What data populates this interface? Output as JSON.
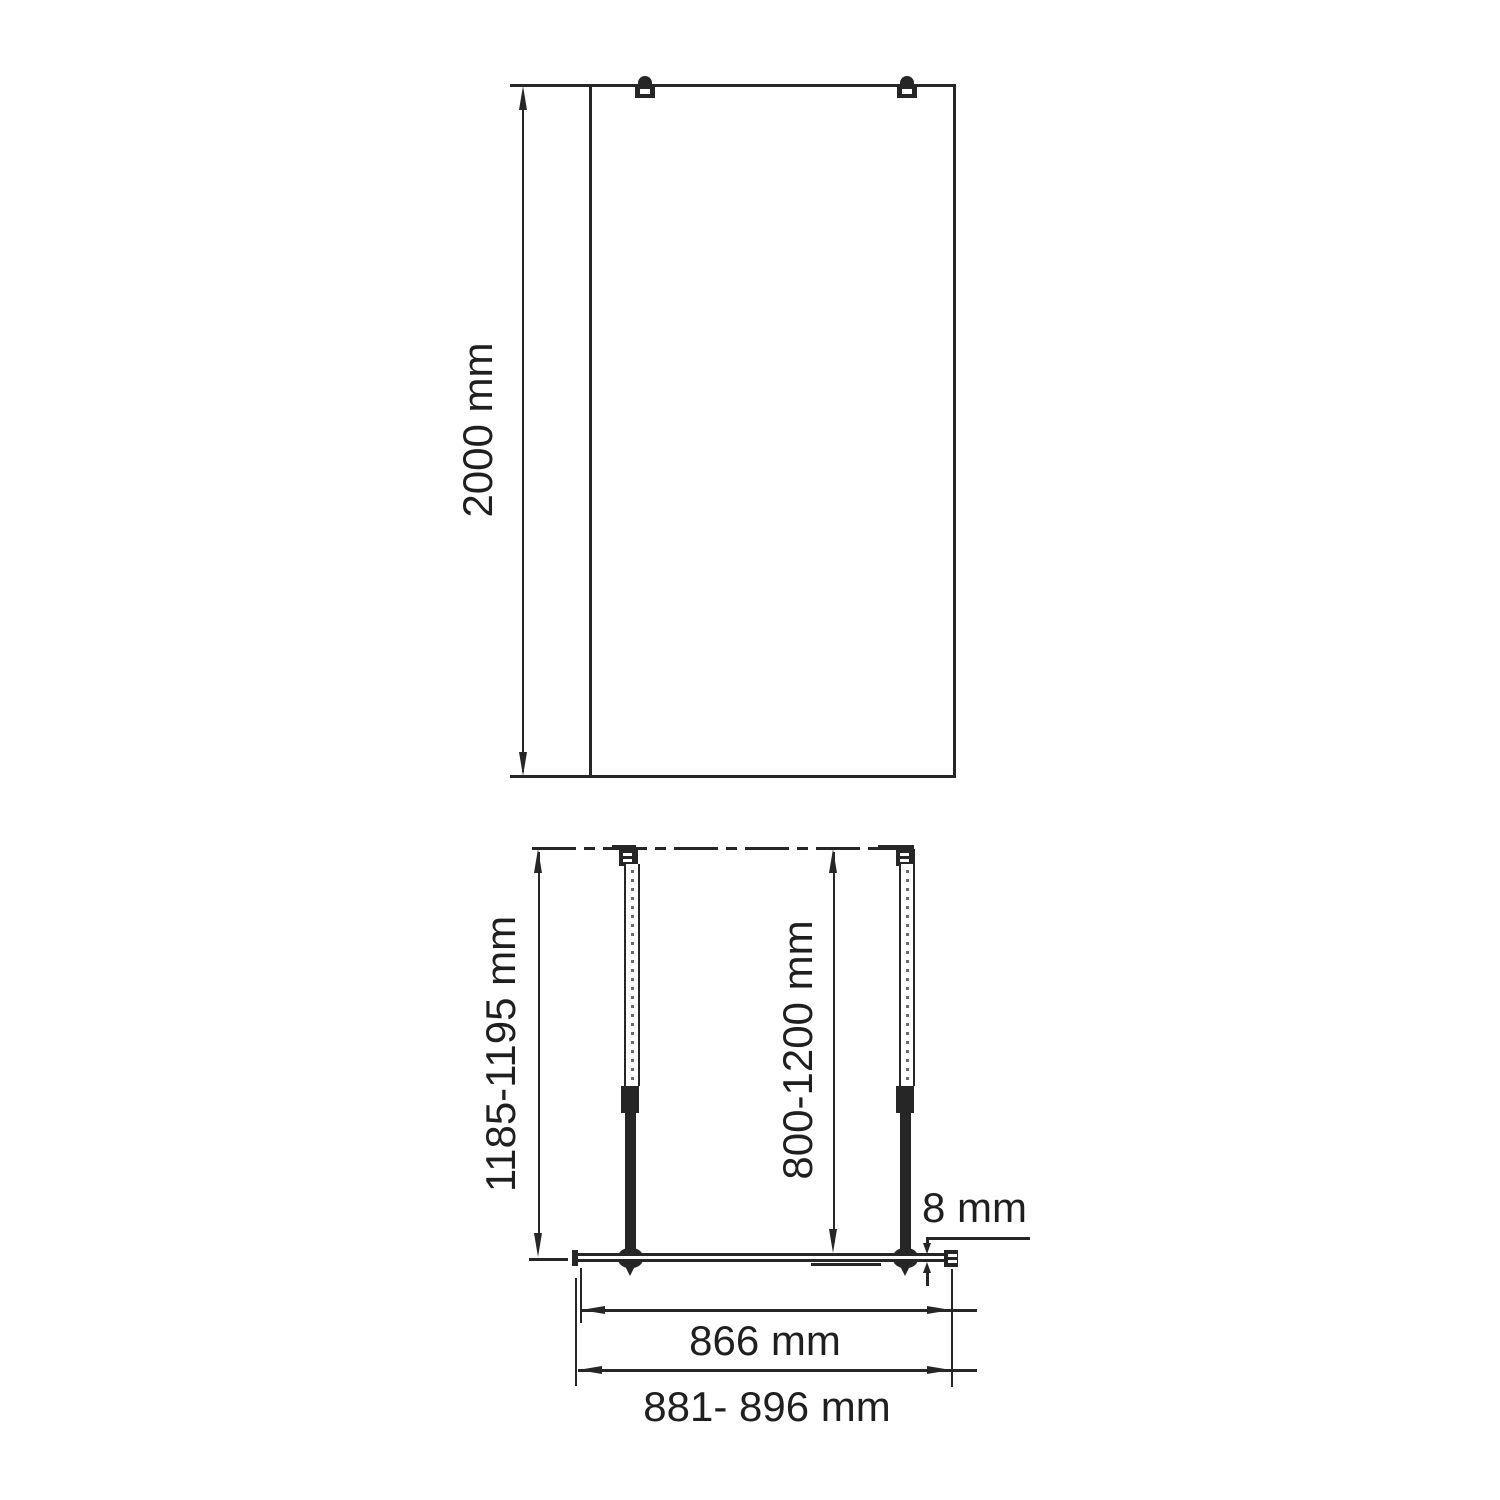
{
  "drawing": {
    "front_view": {
      "height_dim": "2000 mm"
    },
    "plan_view": {
      "wall_to_edge_dim": "1185-1195 mm",
      "support_bar_dim": "800-1200 mm",
      "glass_thickness_dim": "8 mm",
      "glass_width_dim": "866 mm",
      "overall_width_dim": "881- 896 mm"
    },
    "colors": {
      "line": "#262626",
      "background": "#ffffff"
    }
  }
}
